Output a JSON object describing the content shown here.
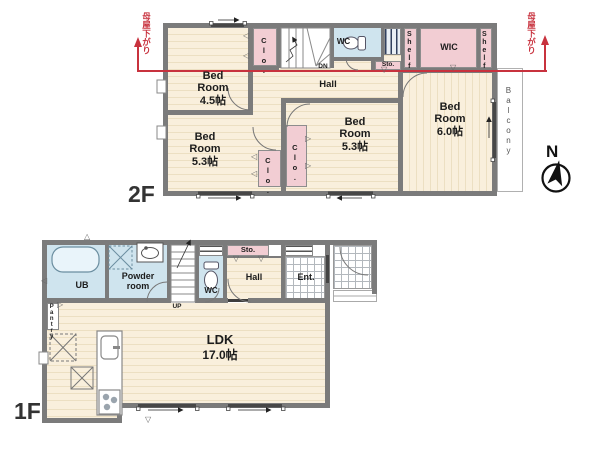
{
  "floor2": {
    "floor_label": "2F",
    "bedroom_a": {
      "name": "Bed Room",
      "size": "4.5帖"
    },
    "bedroom_b": {
      "name": "Bed Room",
      "size": "5.3帖"
    },
    "bedroom_c": {
      "name": "Bed Room",
      "size": "5.3帖"
    },
    "bedroom_d": {
      "name": "Bed Room",
      "size": "6.0帖"
    },
    "hall": "Hall",
    "dn": "DN",
    "wc": "WC",
    "sto": "Sto.",
    "wic": "WIC",
    "shelf_left": "Shelf",
    "shelf_right": "Shelf",
    "clo_top": "Clo.",
    "clo_left": "Clo.",
    "clo_mid": "Clo.",
    "balcony": "Balcony",
    "roof_note_left": "母屋下がり",
    "roof_note_right": "母屋下がり",
    "compass_n": "N"
  },
  "floor1": {
    "floor_label": "1F",
    "ub": "UB",
    "powder": "Powder room",
    "wc": "WC",
    "sto": "Sto.",
    "hall": "Hall",
    "ent": "Ent.",
    "up": "UP",
    "pantry": "Pantry",
    "ldk": {
      "name": "LDK",
      "size": "17.0帖"
    }
  },
  "glyphs": {
    "flap_left": "◁",
    "flap_right": "▷",
    "flap_down": "▽",
    "flap_up": "△"
  },
  "colors": {
    "wood": "#f9efdc",
    "wood_stripe": "#ecdfc2",
    "wet_blue": "#cfe4ee",
    "closet_pink": "#f2cdd3",
    "wall_gray": "#7b7b7b",
    "roof_line_red": "#c8323e"
  }
}
